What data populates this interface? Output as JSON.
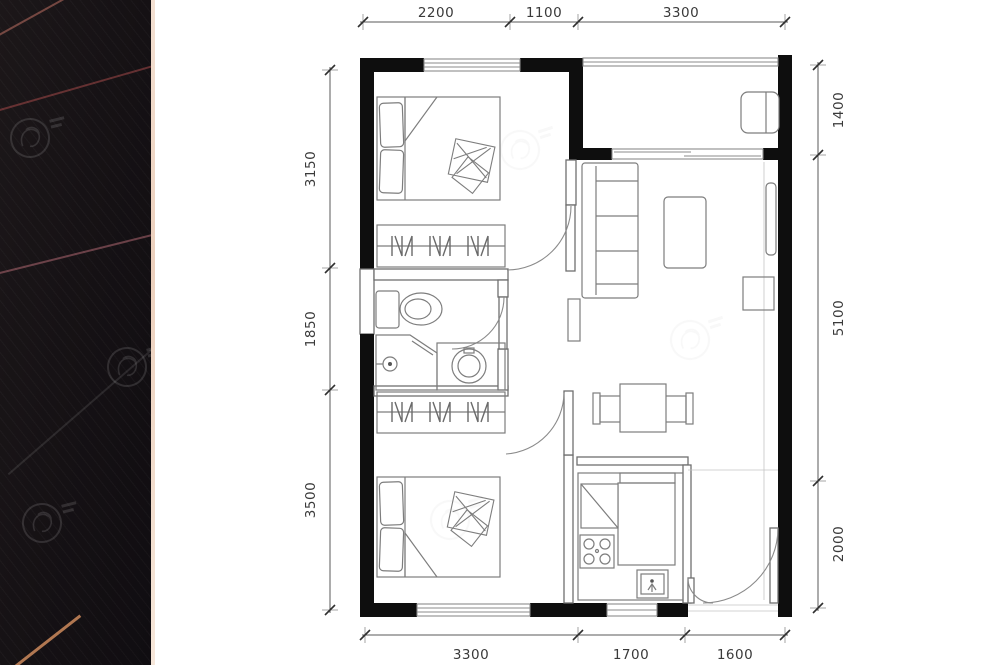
{
  "photo_strip": {
    "watermark_label": "UD",
    "edge_color": "#eed5c4",
    "streak_colors": {
      "red": "#a84848",
      "pink": "#d07b86",
      "orange": "#e59a66"
    }
  },
  "floor_plan": {
    "colors": {
      "wall": "#0e0e0e",
      "thin_wall": "#6f6f6f",
      "furniture_line": "#7d7d7d",
      "dimension_text": "#3a3a3a",
      "dimension_line": "#5a5a5a"
    },
    "dimensions": {
      "top": [
        "2200",
        "1100",
        "3300"
      ],
      "bottom": [
        "3300",
        "1700",
        "1600"
      ],
      "left": [
        "3150",
        "1850",
        "3500"
      ],
      "right": [
        "1400",
        "5100",
        "2000"
      ]
    }
  }
}
